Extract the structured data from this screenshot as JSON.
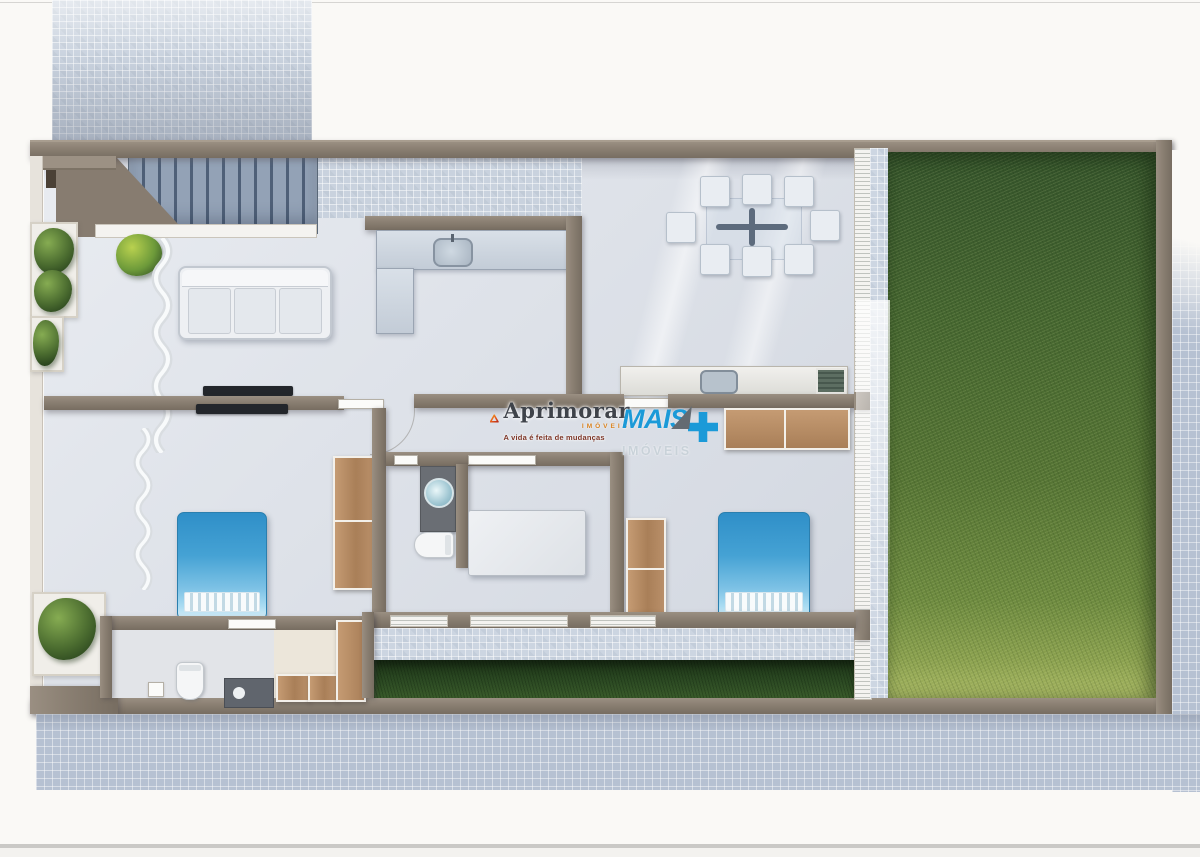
{
  "watermarks": {
    "aprimorar": {
      "brand": "Aprimorar",
      "industry_label": "IMÓVEIS",
      "tagline": "A vida é feita de mudanças",
      "logo": "penrose-triangle-icon",
      "triangle_colors": [
        "#f6a21c",
        "#e4581c",
        "#b92c1a"
      ],
      "text_color": "#3f434a",
      "accent_color": "#d9821f",
      "tagline_color": "#7d3526"
    },
    "mais": {
      "brand": "MAIS",
      "industry_label": "IMÓVEIS",
      "logo": "plus-icon",
      "brand_color": "#1b9ad8",
      "label_color": "#c9d2d9",
      "arrow_color": "#646b72"
    }
  },
  "palette": {
    "page_background": "#faf9f6",
    "wall_taupe": "#8b8073",
    "wall_edge_dark": "#6e655a",
    "floor_gray": "#dee2e9",
    "terrace_tile": "#c9d2de",
    "sidewalk_tile": "#b6c1d2",
    "lawn_dark": "#33522a",
    "lawn_light": "#a7b762",
    "grass_strip_dark": "#1d3518",
    "bed_blue": "#3b9bd1",
    "wood_brown": "#b58a63",
    "stairs_blue_gray": "#5b6c82",
    "counter_blue_gray": "#ccd5e0"
  },
  "scene": {
    "type": "residential house floor plan, 3D top-down render",
    "rooms": [
      "driveway-tiled",
      "staircase",
      "living-room",
      "kitchen",
      "gourmet-dining-terrace",
      "hallway",
      "bedroom-left",
      "bathroom-center",
      "bedroom-middle",
      "bedroom-right",
      "bathroom-bottom",
      "closet-laundry",
      "side-garden-strip",
      "backyard-lawn",
      "perimeter-sidewalk"
    ],
    "furniture": [
      "sofa-3-seat",
      "wall-tv-living",
      "wall-tv-bedroom",
      "kitchen-l-counter-with-sink",
      "glass-dining-table",
      "dining-chairs-x8",
      "bbq-counter-with-sink-and-grill",
      "double-bed-blue-left",
      "double-bed-blue-right",
      "bed-white-middle",
      "wardrobe-wood-x4",
      "washbasin-counter",
      "toilet-x2",
      "shower",
      "curtains-wavy-x2",
      "potted-plants-x4",
      "dining-table-cross-base"
    ]
  }
}
